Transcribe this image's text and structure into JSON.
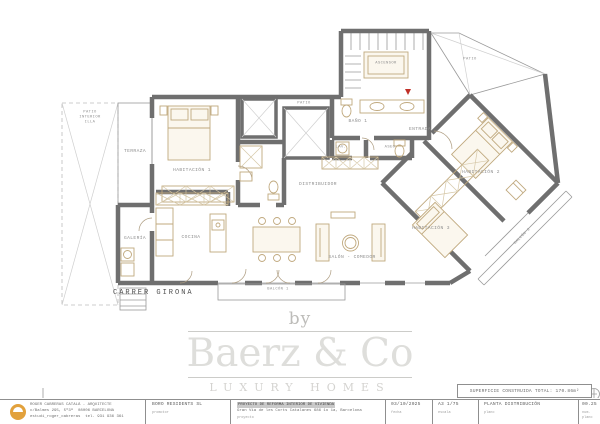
{
  "plan": {
    "street_label": "CARRER GIRONA",
    "rooms": [
      {
        "id": "terraza",
        "label": "TERRAZA"
      },
      {
        "id": "habitacion-1",
        "label": "HABITACIÓN 1"
      },
      {
        "id": "galeria",
        "label": "GALERÍA"
      },
      {
        "id": "cocina",
        "label": "COCINA"
      },
      {
        "id": "salon-comedor",
        "label": "SALÓN - COMEDOR"
      },
      {
        "id": "distribuidor",
        "label": "DISTRIBUIDOR"
      },
      {
        "id": "bano-1",
        "label": "BAÑO 1"
      },
      {
        "id": "lavadero",
        "label": "LAV."
      },
      {
        "id": "aseo",
        "label": "ASEO"
      },
      {
        "id": "patio",
        "label": "PATIO"
      },
      {
        "id": "entrada",
        "label": "ENTRADA"
      },
      {
        "id": "ascensor",
        "label": "ASCENSOR"
      },
      {
        "id": "habitacion-2",
        "label": "HABITACIÓN 2"
      },
      {
        "id": "habitacion-3",
        "label": "HABITACIÓN 3"
      },
      {
        "id": "balcon-1",
        "label": "BALCÓN 1"
      },
      {
        "id": "balcon-2",
        "label": "BALCÓN 2"
      },
      {
        "id": "patio-superior",
        "label": "PATIO"
      },
      {
        "id": "patio-illa",
        "label": "PATIO\nINTERIOR\nILLA"
      }
    ]
  },
  "watermark": {
    "by": "by",
    "brand": "Baerz & Co",
    "tagline": "LUXURY HOMES"
  },
  "surface_badge": {
    "text": "SUPERFICIE CONSTRUIDA TOTAL: 170.86m²"
  },
  "title_block": {
    "architect": {
      "name": "ROGER CABRERAS CATALÀ - ARQUITECTE",
      "address_left": "c/Balmes 295, 5º3ª",
      "address_right": "08006 BARCELONA",
      "handle": "estudi_roger_cabreras",
      "phone": "tel. 931 936 361"
    },
    "promoter": {
      "value": "BORO RESIDENTS SL",
      "label": "promotor"
    },
    "project": {
      "line1": "PROYECTO DE REFORMA INTERIOR DE VIVIENDA",
      "line2": "Gran Via de les Corts Catalanes 686 1o 1a, Barcelona",
      "label": "proyecto"
    },
    "date": {
      "value": "03/10/2025",
      "label": "fecha"
    },
    "scale": {
      "value": "A3 1/75",
      "label": "escala"
    },
    "sheet": {
      "value": "PLANTA DISTRIBUCIÓN",
      "label": "plano"
    },
    "number": {
      "value": "00.25",
      "label": "num. plano"
    }
  }
}
